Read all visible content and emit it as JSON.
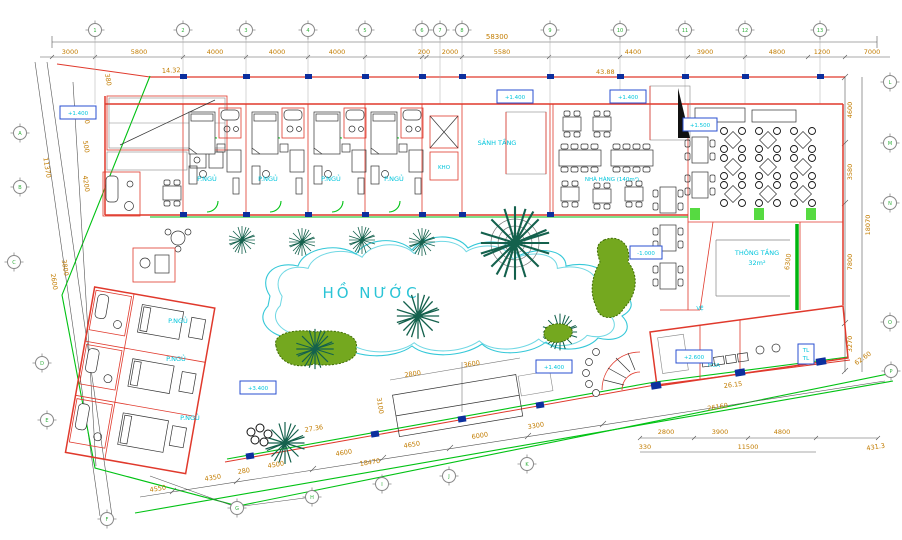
{
  "labels": {
    "pond": "HỒ NƯỚC",
    "bedroom": "P.NGỦ",
    "storage": "KHO",
    "lobby": "SẢNH TẦNG",
    "restaurant": "NHÀ HÀNG (140m²)",
    "void": "THÔNG TẦNG",
    "void_area": "32m²",
    "wc": "VỆ",
    "planter": "HOA",
    "tl": "TL"
  },
  "elevations": {
    "a": "+1.400",
    "b": "+1.500",
    "c": "+2.600",
    "d": "+3.400",
    "e": "-1.000"
  },
  "dims": {
    "top": [
      "3000",
      "5800",
      "4000",
      "4000",
      "4000",
      "200",
      "2000",
      "5580",
      "4400",
      "3900",
      "4800",
      "1200",
      "7000"
    ],
    "top_overall": "58300",
    "run_left": "14.32",
    "run_right": "43.88",
    "left_outer": "11370",
    "left": [
      "380",
      "4000",
      "500",
      "4200"
    ],
    "left_lower": [
      "3800",
      "2600"
    ],
    "right": [
      "4600",
      "3580",
      "7800",
      "3270"
    ],
    "right_overall": "18070",
    "right_corner": "62.60",
    "right_edge": "431.3",
    "bottom": [
      "4550",
      "4350",
      "280",
      "4500",
      "4600",
      "4650",
      "6000",
      "3300"
    ],
    "bottom_cum": "18470",
    "bottom_run1": "27.36",
    "bottom_run2": "26.15",
    "lower_right": [
      "2800",
      "3900",
      "4800"
    ],
    "lower_right_overall": "11500",
    "lower_right_small": "330",
    "lower_right_cum": "26160",
    "deck": [
      "2800",
      "3600",
      "3100"
    ],
    "void_height": "6300"
  },
  "grid": {
    "top": [
      "1",
      "2",
      "3",
      "4",
      "5",
      "6",
      "7",
      "8",
      "9",
      "10",
      "11",
      "12",
      "13"
    ],
    "left": [
      "A",
      "B",
      "C"
    ],
    "slant": [
      "D",
      "E"
    ],
    "bottom": [
      "F",
      "G",
      "H",
      "I",
      "J",
      "K"
    ],
    "right": [
      "L",
      "M",
      "N",
      "O",
      "P"
    ]
  }
}
